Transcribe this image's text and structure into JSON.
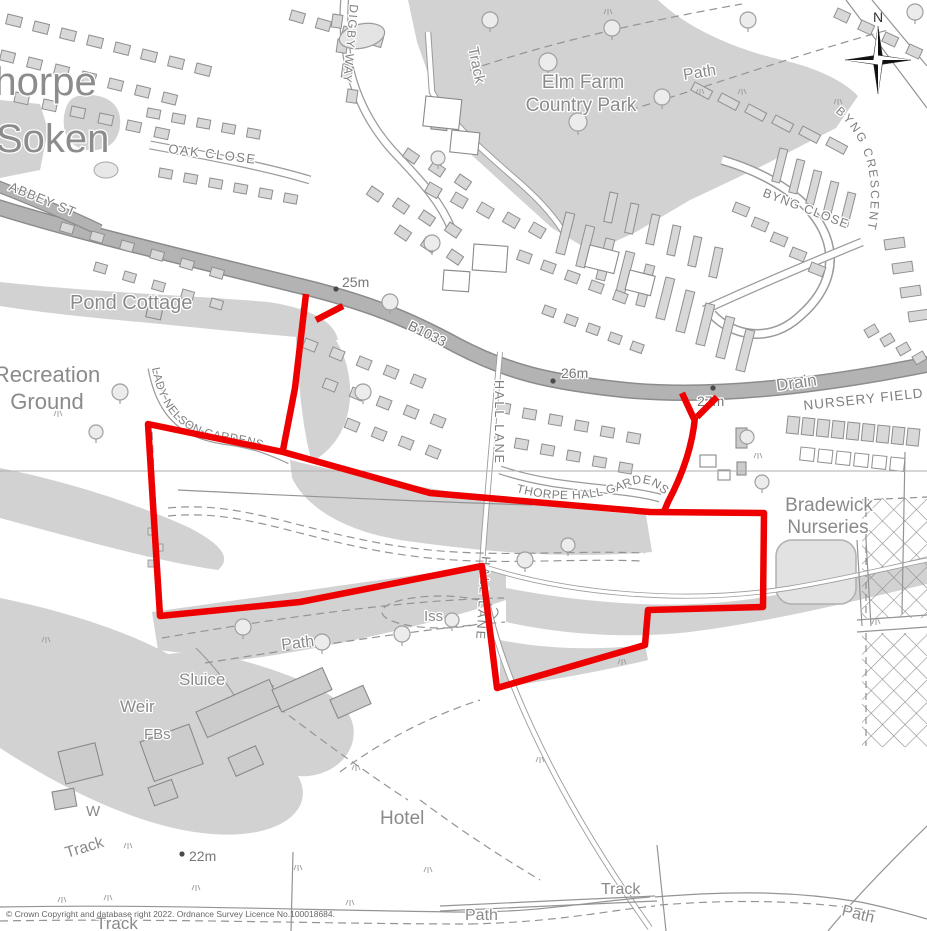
{
  "map": {
    "title": "Ordnance Survey site location plan, Thorpe-le-Soken",
    "attribution": "© Crown Copyright and database right 2022. Ordnance Survey Licence No.100018684.",
    "compass": {
      "north_label": "N"
    }
  },
  "labels": {
    "thorpe": "Thorpe",
    "soken": "Soken",
    "oak_close": "OAK CLOSE",
    "abbey_st": "ABBEY ST",
    "digby_way": "DIGBY WAY",
    "track_top": "Track",
    "elm_farm_1": "Elm Farm",
    "elm_farm_2": "Country Park",
    "path_top": "Path",
    "byng_crescent": "BYNG CRESCENT",
    "byng_close": "BYNG CLOSE",
    "pond_cottage": "Pond Cottage",
    "recreation_1": "Recreation",
    "recreation_2": "Ground",
    "b1033": "B1033",
    "spot_25": "25m",
    "spot_26": "26m",
    "spot_27": "27m",
    "spot_22": "22m",
    "lady_nelson": "LADY NELSON GARDENS",
    "hall_lane_n": "HALL LANE",
    "hall_lane_s": "HALL LANE",
    "thorpe_hall_gardens": "THORPE HALL GARDENS",
    "drain": "Drain",
    "nursery_field": "NURSERY FIELD",
    "bradewick_1": "Bradewick",
    "bradewick_2": "Nurseries",
    "iss": "Iss",
    "path_mid": "Path",
    "sluice": "Sluice",
    "weir": "Weir",
    "fbs": "FBs",
    "w": "W",
    "track_sw": "Track",
    "hotel": "Hotel",
    "track_s": "Track",
    "path_s": "Path",
    "path_se": "Path",
    "track_sw2": "Track"
  },
  "colors": {
    "site_boundary": "#ee0000",
    "road_fill": "#b3b3b3",
    "road_casing": "#8c8c8c",
    "area_gray": "#d2d2d2",
    "building_fill": "#d8d8d8",
    "label_gray": "#8a8a8a"
  }
}
